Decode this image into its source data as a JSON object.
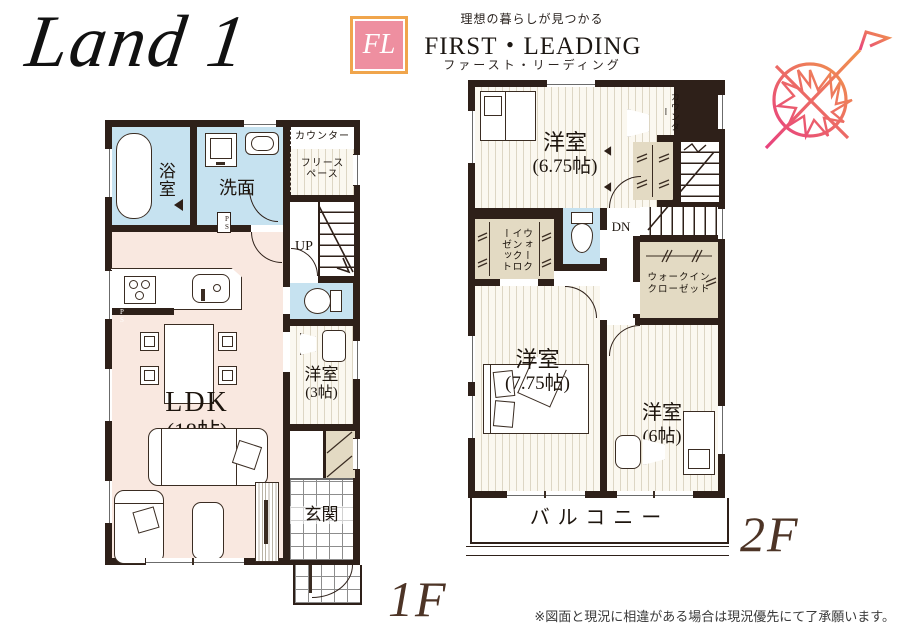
{
  "header": {
    "plan_title": "Land 1",
    "logo": {
      "monogram": "FL",
      "tagline": "理想の暮らしが見つかる",
      "brand": "FIRST・LEADING",
      "brand_kana": "ファースト・リーディング"
    }
  },
  "floor1": {
    "label": "1F",
    "bath": "浴室",
    "washroom": "洗面",
    "counter": "カウンター",
    "free_space": "フリースペース",
    "stairs": "UP",
    "ldk_name": "LDK",
    "ldk_size": "(18帖)",
    "western3_name": "洋室",
    "western3_size": "(3帖)",
    "entrance": "玄関",
    "pipe_space": "PS"
  },
  "floor2": {
    "label": "2F",
    "w675_name": "洋室",
    "w675_size": "(6.75帖)",
    "counter": "カウンター",
    "stairs": "DN",
    "walk_in_closet": "ウォークインクローゼット",
    "walk_in_closet_l1": "ウォークイン",
    "walk_in_closet_l2": "クローゼット",
    "w775_name": "洋室",
    "w775_size": "(7.75帖)",
    "w6_name": "洋室",
    "w6_size": "(6帖)",
    "balcony": "バルコニー"
  },
  "footer": {
    "disclaimer": "※図面と現況に相違がある場合は現況優先にて了承願います。"
  },
  "colors": {
    "wall": "#2e2019",
    "ldk_floor": "#f9e8e0",
    "wet_floor": "#c6e2f0",
    "closet_floor": "#e3dac3",
    "logo_pink": "#ee8fa0",
    "logo_border": "#f0a54c",
    "floor_label_brown": "#4d3426",
    "compass_pink": "#e8427e",
    "compass_orange": "#f0924d"
  }
}
